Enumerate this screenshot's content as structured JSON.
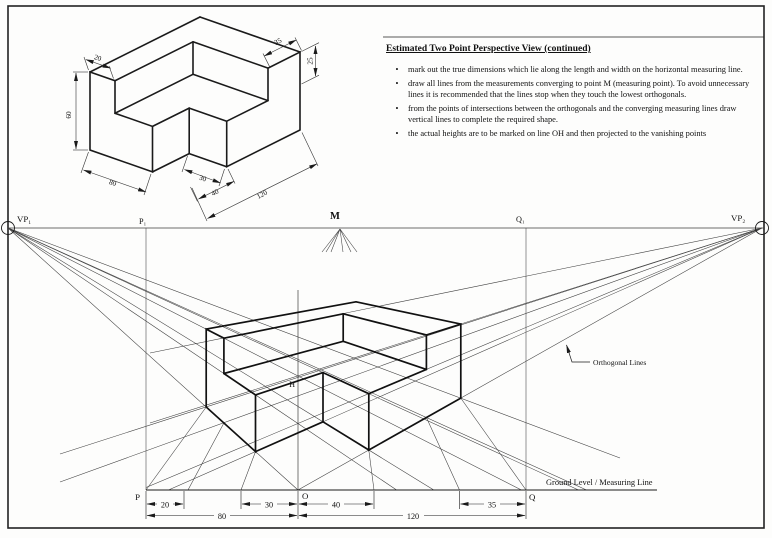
{
  "instructions": {
    "title": "Estimated Two Point Perspective View (continued)",
    "bullet_char": "•",
    "bullets": [
      "mark out the true dimensions which lie along the length and width on the horizontal measuring line.",
      "draw all lines from the measurements converging to point M (measuring point).  To avoid unnecessary lines it is recommended that the lines stop when they touch the lowest orthogonals.",
      "from the points of intersections between the orthogonals and the converging measuring lines draw vertical lines to complete the required shape.",
      "the actual heights are to be marked on line OH and then projected to the vanishing points"
    ]
  },
  "iso_view": {
    "dims": {
      "length": "120",
      "width": "80",
      "height": "60",
      "notch_width": "40",
      "notch_depth": "30",
      "back_wall": "20",
      "right_wall": "35",
      "pocket_depth": "25"
    }
  },
  "perspective": {
    "labels": {
      "vp1": "VP₁",
      "p1": "P₁",
      "m": "M",
      "q1": "Q₁",
      "vp2": "VP₂",
      "h": "H",
      "p": "P",
      "o": "O",
      "q": "Q"
    },
    "ground_label": "Ground Level / Measuring Line",
    "orthogonal_label": "Orthogonal Lines",
    "dims": {
      "d20": "20",
      "d30": "30",
      "d40": "40",
      "d35": "35",
      "d80": "80",
      "d120": "120"
    }
  },
  "colors": {
    "ink": "#1a1a1a",
    "construction": "#3d3d3d",
    "paper": "#fdfdfc"
  }
}
